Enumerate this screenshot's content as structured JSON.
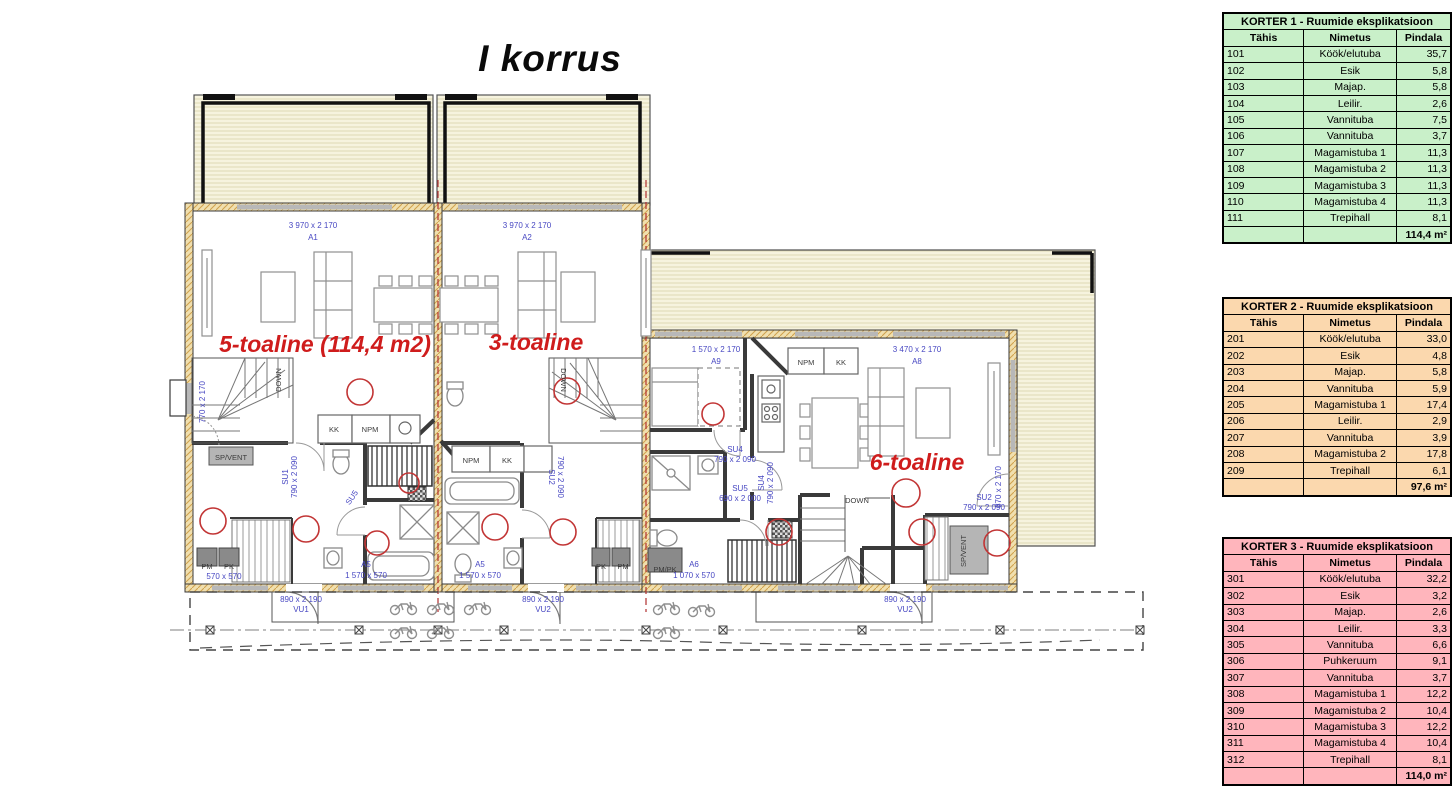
{
  "title": "I korrus",
  "colors": {
    "accent_red": "#cf1c1c",
    "label_blue": "#4747c2",
    "terrace_fill": "#f6f3de",
    "wall_insulation": "#f0dfae",
    "table1_bg": "#c9f0c9",
    "table2_bg": "#fbd8ae",
    "table3_bg": "#ffb5bc"
  },
  "plan": {
    "apartment_labels": [
      {
        "t": "5-toaline (114,4 m2)",
        "x": 325,
        "y": 352,
        "c": "r",
        "s": 23
      },
      {
        "t": "3-toaline",
        "x": 536,
        "y": 350,
        "c": "r",
        "s": 23
      },
      {
        "t": "6-toaline",
        "x": 917,
        "y": 470,
        "c": "r",
        "s": 25
      }
    ],
    "labels": [
      {
        "t": "3 970 x 2 170",
        "x": 313,
        "y": 228,
        "c": "b"
      },
      {
        "t": "A1",
        "x": 313,
        "y": 240,
        "c": "b"
      },
      {
        "t": "3 970 x 2 170",
        "x": 527,
        "y": 228,
        "c": "b"
      },
      {
        "t": "A2",
        "x": 527,
        "y": 240,
        "c": "b"
      },
      {
        "t": "1 570 x 2 170",
        "x": 716,
        "y": 352,
        "c": "b"
      },
      {
        "t": "A9",
        "x": 716,
        "y": 364,
        "c": "b"
      },
      {
        "t": "3 470 x 2 170",
        "x": 917,
        "y": 352,
        "c": "b"
      },
      {
        "t": "A8",
        "x": 917,
        "y": 364,
        "c": "b"
      },
      {
        "t": "770 x 2 170",
        "x": 205,
        "y": 402,
        "c": "b",
        "r": -90
      },
      {
        "t": "SU1",
        "x": 288,
        "y": 477,
        "c": "b",
        "r": -90
      },
      {
        "t": "790 x 2 090",
        "x": 297,
        "y": 477,
        "c": "b",
        "r": -90
      },
      {
        "t": "SU5",
        "x": 354,
        "y": 499,
        "c": "b",
        "r": -55
      },
      {
        "t": "SU2",
        "x": 549,
        "y": 477,
        "c": "b",
        "r": 90
      },
      {
        "t": "790 x 2 090",
        "x": 558,
        "y": 477,
        "c": "b",
        "r": 90
      },
      {
        "t": "SU4",
        "x": 735,
        "y": 452,
        "c": "b"
      },
      {
        "t": "790 x 2 090",
        "x": 735,
        "y": 462,
        "c": "b"
      },
      {
        "t": "SU5",
        "x": 740,
        "y": 491,
        "c": "b"
      },
      {
        "t": "690 x 2 000",
        "x": 740,
        "y": 501,
        "c": "b"
      },
      {
        "t": "SU4",
        "x": 764,
        "y": 483,
        "c": "b",
        "r": -90
      },
      {
        "t": "790 x 2 090",
        "x": 773,
        "y": 483,
        "c": "b",
        "r": -90
      },
      {
        "t": "SU2",
        "x": 984,
        "y": 500,
        "c": "b"
      },
      {
        "t": "790 x 2 090",
        "x": 984,
        "y": 510,
        "c": "b"
      },
      {
        "t": "870 x 2 170",
        "x": 1001,
        "y": 487,
        "c": "b",
        "r": -90
      },
      {
        "t": "570 x 570",
        "x": 224,
        "y": 579,
        "c": "b"
      },
      {
        "t": "A5",
        "x": 366,
        "y": 567,
        "c": "b"
      },
      {
        "t": "1 570 x 570",
        "x": 366,
        "y": 578,
        "c": "b"
      },
      {
        "t": "A5",
        "x": 480,
        "y": 567,
        "c": "b"
      },
      {
        "t": "1 570 x 570",
        "x": 480,
        "y": 578,
        "c": "b"
      },
      {
        "t": "A6",
        "x": 694,
        "y": 567,
        "c": "b"
      },
      {
        "t": "1 070 x 570",
        "x": 694,
        "y": 578,
        "c": "b"
      },
      {
        "t": "890 x 2 190",
        "x": 301,
        "y": 602,
        "c": "b"
      },
      {
        "t": "VU1",
        "x": 301,
        "y": 612,
        "c": "b"
      },
      {
        "t": "890 x 2 190",
        "x": 543,
        "y": 602,
        "c": "b"
      },
      {
        "t": "VU2",
        "x": 543,
        "y": 612,
        "c": "b"
      },
      {
        "t": "890 x 2 190",
        "x": 905,
        "y": 602,
        "c": "b"
      },
      {
        "t": "VU2",
        "x": 905,
        "y": 612,
        "c": "b"
      },
      {
        "t": "KK",
        "x": 334,
        "y": 432,
        "c": "d"
      },
      {
        "t": "NPM",
        "x": 370,
        "y": 432,
        "c": "d"
      },
      {
        "t": "NPM",
        "x": 471,
        "y": 463,
        "c": "d"
      },
      {
        "t": "KK",
        "x": 507,
        "y": 463,
        "c": "d"
      },
      {
        "t": "NPM",
        "x": 806,
        "y": 365,
        "c": "d"
      },
      {
        "t": "KK",
        "x": 841,
        "y": 365,
        "c": "d"
      },
      {
        "t": "SP/VENT",
        "x": 231,
        "y": 460,
        "c": "d"
      },
      {
        "t": "SP/VENT",
        "x": 966,
        "y": 551,
        "c": "d",
        "r": -90
      },
      {
        "t": "PM",
        "x": 207,
        "y": 569,
        "c": "d"
      },
      {
        "t": "PK",
        "x": 229,
        "y": 569,
        "c": "d"
      },
      {
        "t": "PK",
        "x": 601,
        "y": 569,
        "c": "d"
      },
      {
        "t": "PM",
        "x": 623,
        "y": 569,
        "c": "d"
      },
      {
        "t": "PM/PK",
        "x": 665,
        "y": 572,
        "c": "d"
      },
      {
        "t": "DOWN",
        "x": 857,
        "y": 503,
        "c": "d"
      },
      {
        "t": "DOWN",
        "x": 281,
        "y": 380,
        "c": "d",
        "r": -90
      },
      {
        "t": "DOWN",
        "x": 561,
        "y": 380,
        "c": "d",
        "r": 90
      }
    ],
    "circles": [
      {
        "x": 360,
        "y": 392,
        "r": 13
      },
      {
        "x": 213,
        "y": 521,
        "r": 13
      },
      {
        "x": 306,
        "y": 529,
        "r": 13
      },
      {
        "x": 377,
        "y": 543,
        "r": 12
      },
      {
        "x": 495,
        "y": 527,
        "r": 13
      },
      {
        "x": 563,
        "y": 532,
        "r": 13
      },
      {
        "x": 567,
        "y": 391,
        "r": 13
      },
      {
        "x": 713,
        "y": 414,
        "r": 11
      },
      {
        "x": 779,
        "y": 532,
        "r": 13
      },
      {
        "x": 906,
        "y": 493,
        "r": 14
      },
      {
        "x": 922,
        "y": 532,
        "r": 13
      },
      {
        "x": 997,
        "y": 543,
        "r": 13
      },
      {
        "x": 409,
        "y": 483,
        "r": 10
      }
    ]
  },
  "tables": [
    {
      "title": "KORTER 1 - Ruumide eksplikatsioon",
      "bg": "#c9f0c9",
      "headers": [
        "Tähis",
        "Nimetus",
        "Pindala"
      ],
      "rows": [
        [
          "101",
          "Köök/elutuba",
          "35,7"
        ],
        [
          "102",
          "Esik",
          "5,8"
        ],
        [
          "103",
          "Majap.",
          "5,8"
        ],
        [
          "104",
          "Leilir.",
          "2,6"
        ],
        [
          "105",
          "Vannituba",
          "7,5"
        ],
        [
          "106",
          "Vannituba",
          "3,7"
        ],
        [
          "107",
          "Magamistuba 1",
          "11,3"
        ],
        [
          "108",
          "Magamistuba 2",
          "11,3"
        ],
        [
          "109",
          "Magamistuba 3",
          "11,3"
        ],
        [
          "110",
          "Magamistuba 4",
          "11,3"
        ],
        [
          "111",
          "Trepihall",
          "8,1"
        ]
      ],
      "total": "114,4 m²"
    },
    {
      "title": "KORTER 2 - Ruumide eksplikatsioon",
      "bg": "#fbd8ae",
      "headers": [
        "Tähis",
        "Nimetus",
        "Pindala"
      ],
      "rows": [
        [
          "201",
          "Köök/elutuba",
          "33,0"
        ],
        [
          "202",
          "Esik",
          "4,8"
        ],
        [
          "203",
          "Majap.",
          "5,8"
        ],
        [
          "204",
          "Vannituba",
          "5,9"
        ],
        [
          "205",
          "Magamistuba 1",
          "17,4"
        ],
        [
          "206",
          "Leilir.",
          "2,9"
        ],
        [
          "207",
          "Vannituba",
          "3,9"
        ],
        [
          "208",
          "Magamistuba 2",
          "17,8"
        ],
        [
          "209",
          "Trepihall",
          "6,1"
        ]
      ],
      "total": "97,6 m²"
    },
    {
      "title": "KORTER 3 - Ruumide eksplikatsioon",
      "bg": "#ffb5bc",
      "headers": [
        "Tähis",
        "Nimetus",
        "Pindala"
      ],
      "rows": [
        [
          "301",
          "Köök/elutuba",
          "32,2"
        ],
        [
          "302",
          "Esik",
          "3,2"
        ],
        [
          "303",
          "Majap.",
          "2,6"
        ],
        [
          "304",
          "Leilir.",
          "3,3"
        ],
        [
          "305",
          "Vannituba",
          "6,6"
        ],
        [
          "306",
          "Puhkeruum",
          "9,1"
        ],
        [
          "307",
          "Vannituba",
          "3,7"
        ],
        [
          "308",
          "Magamistuba 1",
          "12,2"
        ],
        [
          "309",
          "Magamistuba 2",
          "10,4"
        ],
        [
          "310",
          "Magamistuba 3",
          "12,2"
        ],
        [
          "311",
          "Magamistuba 4",
          "10,4"
        ],
        [
          "312",
          "Trepihall",
          "8,1"
        ]
      ],
      "total": "114,0 m²"
    }
  ]
}
